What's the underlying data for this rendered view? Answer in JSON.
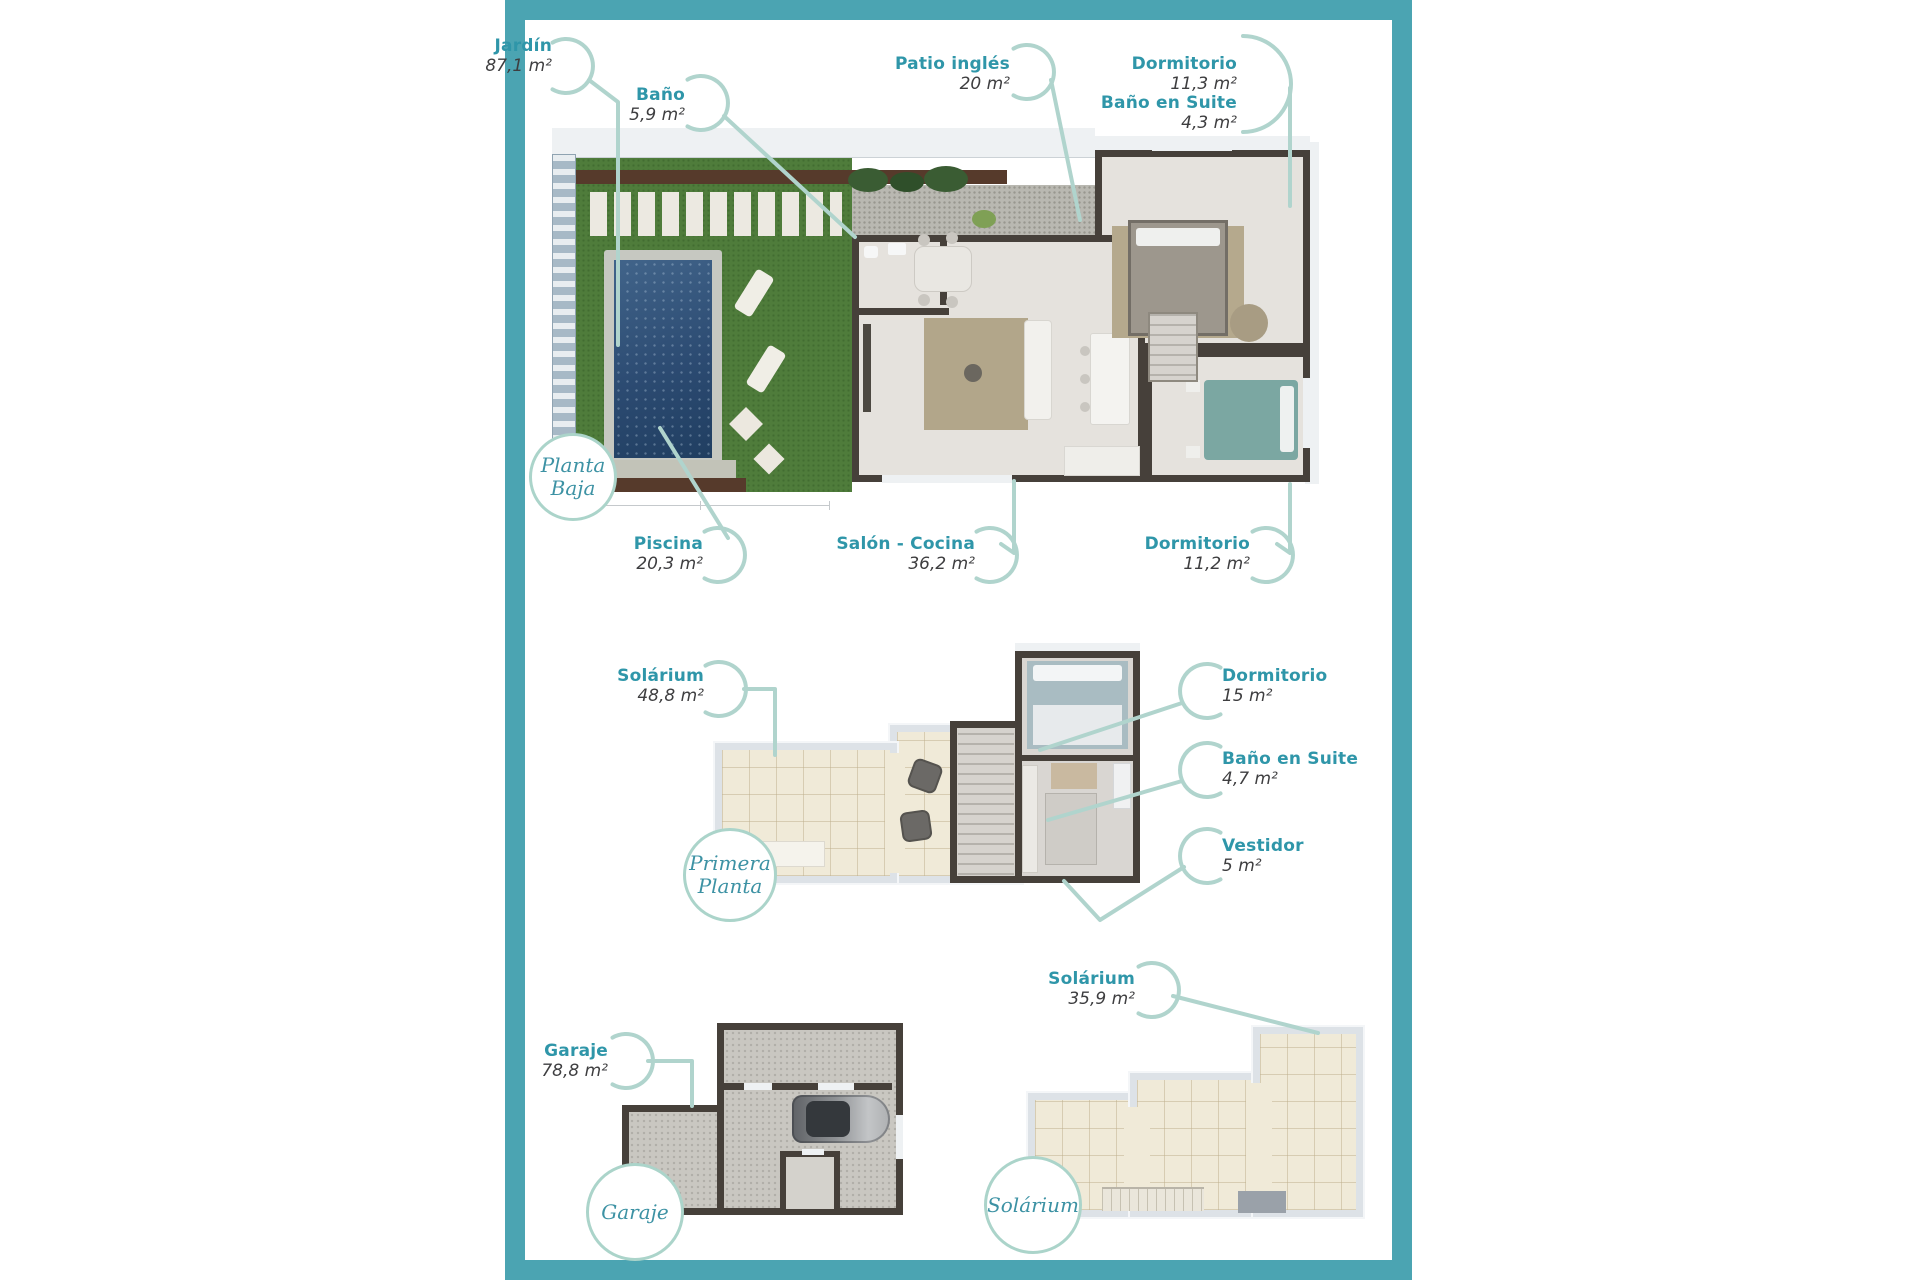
{
  "palette": {
    "frame": "#4ba4b2",
    "label_teal": "#2f96a9",
    "label_dark": "#3e3e40",
    "leader": "#b0d4cd",
    "badge_text": "#3d92a4",
    "badge_ring": "#abd4ca",
    "grass": "#4f7c3b",
    "hedge": "#563a2b",
    "pool_water": "#2e517a",
    "pool_deck": "#c6c8c1",
    "wall": "#46403a",
    "floor": "#e5e2dd",
    "cream_tile": "#f0ead8",
    "parapet": "#dde2e7",
    "gravel": "#b9b8b1",
    "garage_floor": "#c9c7c1",
    "fence": "#a7b9c6",
    "roof_edge": "#eef1f3"
  },
  "floors": [
    {
      "id": "planta-baja",
      "badge": {
        "line1": "Planta",
        "line2": "Baja"
      },
      "labels": [
        {
          "id": "jardin",
          "name": "Jardín",
          "area": "87,1 m²"
        },
        {
          "id": "bano",
          "name": "Baño",
          "area": "5,9 m²"
        },
        {
          "id": "patio-ingles",
          "name": "Patio inglés",
          "area": "20 m²"
        },
        {
          "id": "dormitorio-1",
          "name": "Dormitorio",
          "area": "11,3 m²"
        },
        {
          "id": "bano-en-suite",
          "name": "Baño en Suite",
          "area": "4,3 m²"
        },
        {
          "id": "piscina",
          "name": "Piscina",
          "area": "20,3 m²"
        },
        {
          "id": "salon-cocina",
          "name": "Salón - Cocina",
          "area": "36,2 m²"
        },
        {
          "id": "dormitorio-2",
          "name": "Dormitorio",
          "area": "11,2 m²"
        }
      ]
    },
    {
      "id": "primera-planta",
      "badge": {
        "line1": "Primera",
        "line2": "Planta"
      },
      "labels": [
        {
          "id": "solarium-p1",
          "name": "Solárium",
          "area": "48,8 m²"
        },
        {
          "id": "dormitorio-3",
          "name": "Dormitorio",
          "area": "15 m²"
        },
        {
          "id": "bano-en-suite-2",
          "name": "Baño en Suite",
          "area": "4,7 m²"
        },
        {
          "id": "vestidor",
          "name": "Vestidor",
          "area": "5 m²"
        }
      ]
    },
    {
      "id": "garaje",
      "badge": {
        "line1": "Garaje",
        "line2": ""
      },
      "labels": [
        {
          "id": "garaje",
          "name": "Garaje",
          "area": "78,8 m²"
        }
      ]
    },
    {
      "id": "solarium",
      "badge": {
        "line1": "Solárium",
        "line2": ""
      },
      "labels": [
        {
          "id": "solarium-top",
          "name": "Solárium",
          "area": "35,9 m²"
        }
      ]
    }
  ]
}
